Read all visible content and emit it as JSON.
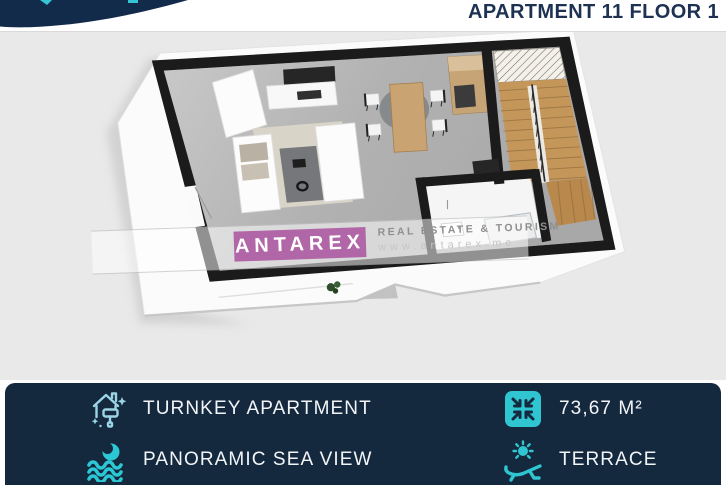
{
  "header": {
    "title": "APARTMENT 11 FLOOR 1"
  },
  "watermark": {
    "brand": "ANTAREX",
    "tagline": "REAL ESTATE & TOURISM",
    "website": "www.antarex.me"
  },
  "features": {
    "left": [
      {
        "icon": "turnkey-house-icon",
        "label": "TURNKEY APARTMENT"
      },
      {
        "icon": "sea-view-icon",
        "label": "PANORAMIC SEA VIEW"
      }
    ],
    "right": [
      {
        "icon": "area-compress-icon",
        "label": "73,67 M²"
      },
      {
        "icon": "terrace-lounger-icon",
        "label": "TERRACE"
      }
    ]
  },
  "colors": {
    "banner_navy": "#15293e",
    "title_navy": "#1d3252",
    "accent_teal": "#2fc6d2",
    "turnkey_icon_cyan": "#9bd4e6",
    "watermark_purple": "#a9529e",
    "plan_background": "#e9e9e9"
  }
}
